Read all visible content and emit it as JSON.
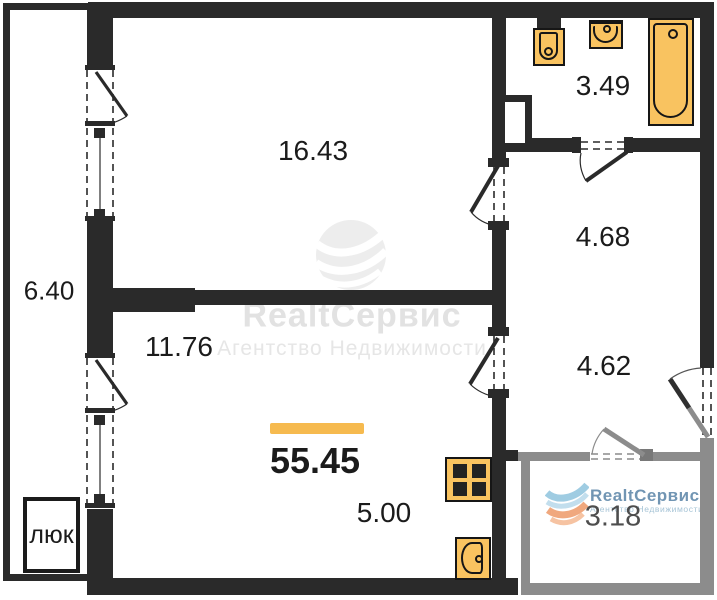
{
  "plan": {
    "total_area": "55.45",
    "hatch_label": "люк",
    "rooms": [
      {
        "name": "living-room-upper",
        "area": "16.43"
      },
      {
        "name": "balcony-left",
        "area": "6.40"
      },
      {
        "name": "living-room-lower",
        "area": "11.76"
      },
      {
        "name": "kitchen-zone",
        "area": "5.00"
      },
      {
        "name": "bathroom",
        "area": "3.49"
      },
      {
        "name": "hall-upper",
        "area": "4.68"
      },
      {
        "name": "hall-lower",
        "area": "4.62"
      },
      {
        "name": "balcony-right",
        "area": "3.18"
      }
    ]
  },
  "watermark": {
    "brand": "RealtСервис",
    "tagline": "Агентство Недвижимости"
  },
  "logo": {
    "brand": "RealtСервис",
    "tagline": "Агентство Недвижимости"
  },
  "colors": {
    "wall": "#2a2a2a",
    "balcony_wall": "#8c8c8c",
    "fixture_fill": "#F9C360",
    "fixture_stroke": "#161616",
    "accent_bar": "#F6BA4F",
    "watermark_gray": "#E3E3E3",
    "logo_blue": "#7195B3",
    "logo_light_blue": "#A9CBDD",
    "logo_orange": "#F0A87E"
  }
}
